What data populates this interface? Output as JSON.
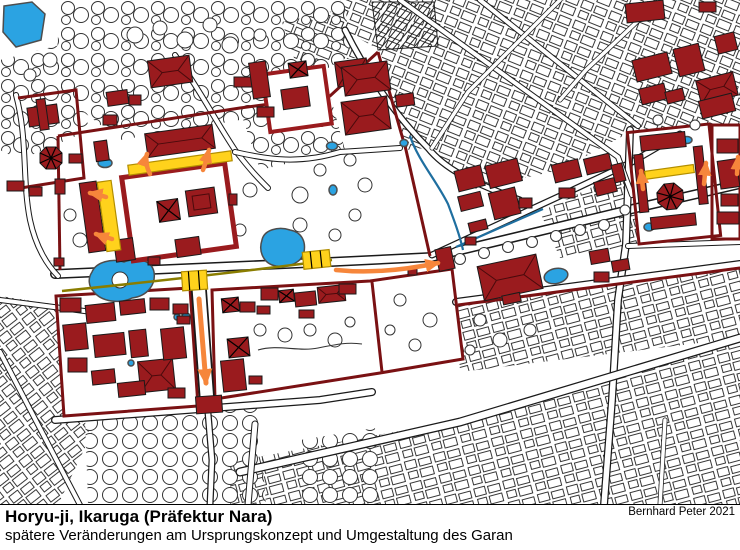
{
  "caption": {
    "title": "Horyu-ji, Ikaruga (Präfektur Nara)",
    "subtitle": "spätere Veränderungen am Ursprungskonzept und Umgestaltung des Garan",
    "attribution": "Bernhard Peter 2021"
  },
  "map": {
    "colors": {
      "building_red": "#9A1B1E",
      "wall_red": "#7A1113",
      "water_blue": "#2BA3E2",
      "stream_blue": "#1F6FA0",
      "highlight_yellow": "#FFD21C",
      "highlight_outline": "#B28E00",
      "axis_olive": "#8A7D00",
      "arrow_orange": "#F6863B",
      "line_black": "#1A1A1A",
      "background": "#FFFFFF"
    }
  }
}
